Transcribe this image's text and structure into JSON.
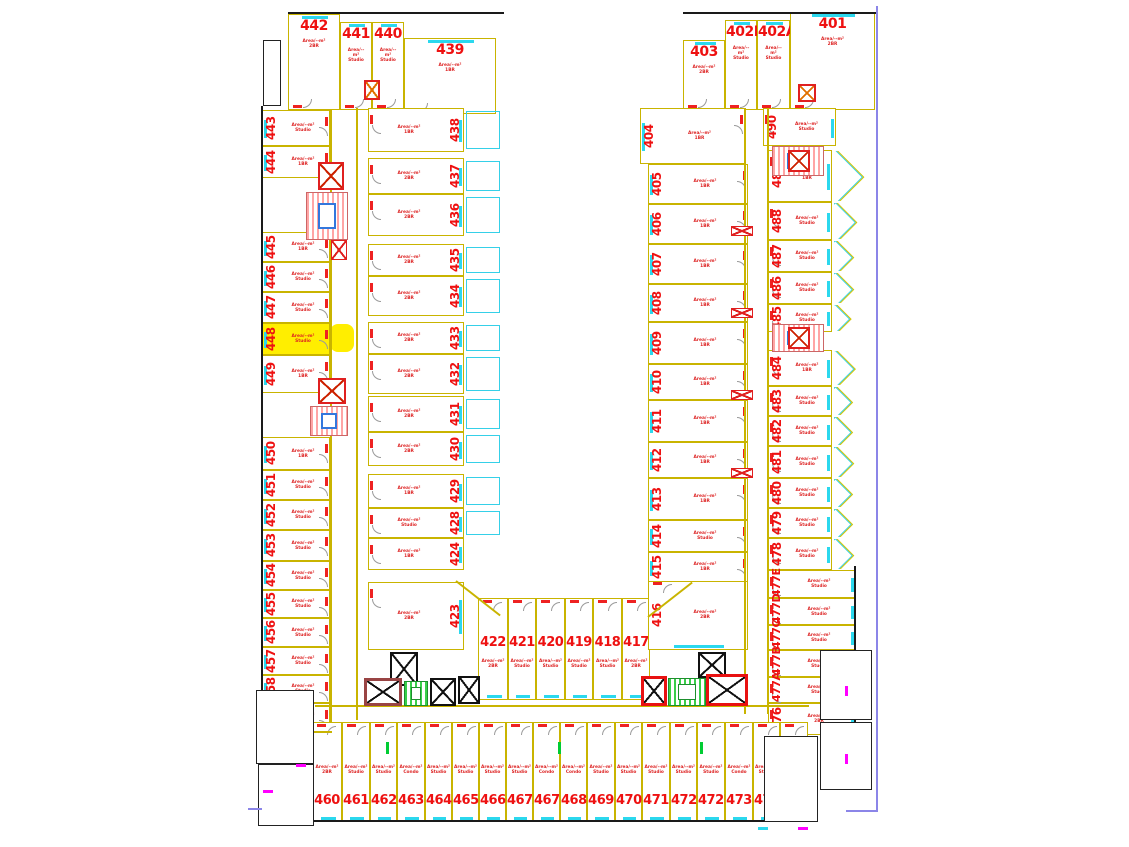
{
  "drawing": {
    "kind": "residential-floor-plan",
    "highlighted_unit": "448",
    "colors": {
      "unit_number_red": "#ee1111",
      "cell_line_yellow": "#c9b400",
      "wall_black": "#1a1a1a",
      "window_cyan": "#2bd8ee",
      "door_red": "#ee2222",
      "highlight_yellow": "#ffee00",
      "boundary_purple": "#8b85e8",
      "stair_hatch_pink": "#ffa5a5",
      "stair_hatch_green": "#39cf4a",
      "elevator_red": "#e02020",
      "tick_magenta": "#ff00ff",
      "tick_green": "#00cc33"
    }
  },
  "groups": {
    "top_left_block": {
      "units": [
        {
          "number": "442",
          "area": "Area/--m²",
          "type": "2BR"
        },
        {
          "number": "441",
          "area": "Area/--m²",
          "type": "Studio"
        },
        {
          "number": "440",
          "area": "Area/--m²",
          "type": "Studio"
        },
        {
          "number": "439",
          "area": "Area/--m²",
          "type": "1BR"
        }
      ]
    },
    "left_outer_column": {
      "units": [
        {
          "number": "443",
          "area": "Area/--m²",
          "type": "Studio"
        },
        {
          "number": "444",
          "area": "Area/--m²",
          "type": "1BR"
        },
        {
          "number": "445",
          "area": "Area/--m²",
          "type": "1BR"
        },
        {
          "number": "446",
          "area": "Area/--m²",
          "type": "Studio"
        },
        {
          "number": "447",
          "area": "Area/--m²",
          "type": "Studio"
        },
        {
          "number": "448",
          "area": "Area/--m²",
          "type": "Studio",
          "highlighted": true
        },
        {
          "number": "449",
          "area": "Area/--m²",
          "type": "1BR"
        },
        {
          "number": "450",
          "area": "Area/--m²",
          "type": "1BR"
        },
        {
          "number": "451",
          "area": "Area/--m²",
          "type": "Studio"
        },
        {
          "number": "452",
          "area": "Area/--m²",
          "type": "Studio"
        },
        {
          "number": "453",
          "area": "Area/--m²",
          "type": "Studio"
        },
        {
          "number": "454",
          "area": "Area/--m²",
          "type": "Studio"
        },
        {
          "number": "455",
          "area": "Area/--m²",
          "type": "Studio"
        },
        {
          "number": "456",
          "area": "Area/--m²",
          "type": "Studio"
        },
        {
          "number": "457",
          "area": "Area/--m²",
          "type": "Studio"
        },
        {
          "number": "458",
          "area": "Area/--m²",
          "type": "Studio"
        },
        {
          "number": "459",
          "area": "Area/--m²",
          "type": "1BR"
        }
      ]
    },
    "left_inner_column": {
      "units": [
        {
          "number": "438",
          "area": "Area/--m²",
          "type": "1BR"
        },
        {
          "number": "437",
          "area": "Area/--m²",
          "type": "2BR"
        },
        {
          "number": "436",
          "area": "Area/--m²",
          "type": "2BR"
        },
        {
          "number": "435",
          "area": "Area/--m²",
          "type": "2BR"
        },
        {
          "number": "434",
          "area": "Area/--m²",
          "type": "2BR"
        },
        {
          "number": "433",
          "area": "Area/--m²",
          "type": "2BR"
        },
        {
          "number": "432",
          "area": "Area/--m²",
          "type": "2BR"
        },
        {
          "number": "431",
          "area": "Area/--m²",
          "type": "2BR"
        },
        {
          "number": "430",
          "area": "Area/--m²",
          "type": "2BR"
        },
        {
          "number": "429",
          "area": "Area/--m²",
          "type": "1BR"
        },
        {
          "number": "428",
          "area": "Area/--m²",
          "type": "Studio"
        },
        {
          "number": "424",
          "area": "Area/--m²",
          "type": "1BR"
        },
        {
          "number": "423",
          "area": "Area/--m²",
          "type": "2BR"
        }
      ]
    },
    "bottom_middle_row": {
      "units": [
        {
          "number": "422",
          "area": "Area/--m²",
          "type": "2BR"
        },
        {
          "number": "421",
          "area": "Area/--m²",
          "type": "Studio"
        },
        {
          "number": "420",
          "area": "Area/--m²",
          "type": "Studio"
        },
        {
          "number": "419",
          "area": "Area/--m²",
          "type": "Studio"
        },
        {
          "number": "418",
          "area": "Area/--m²",
          "type": "Studio"
        },
        {
          "number": "417",
          "area": "Area/--m²",
          "type": "2BR"
        }
      ]
    },
    "unit_416": {
      "units": [
        {
          "number": "416",
          "area": "Area/--m²",
          "type": "2BR"
        }
      ]
    },
    "top_right_block": {
      "units": [
        {
          "number": "403",
          "area": "Area/--m²",
          "type": "2BR"
        },
        {
          "number": "402B",
          "area": "Area/--m²",
          "type": "Studio"
        },
        {
          "number": "402A",
          "area": "Area/--m²",
          "type": "Studio"
        },
        {
          "number": "401",
          "area": "Area/--m²",
          "type": "2BR"
        }
      ]
    },
    "right_inner_column": {
      "units": [
        {
          "number": "404",
          "area": "Area/--m²",
          "type": "1BR"
        },
        {
          "number": "405",
          "area": "Area/--m²",
          "type": "1BR"
        },
        {
          "number": "406",
          "area": "Area/--m²",
          "type": "1BR"
        },
        {
          "number": "407",
          "area": "Area/--m²",
          "type": "1BR"
        },
        {
          "number": "408",
          "area": "Area/--m²",
          "type": "1BR"
        },
        {
          "number": "409",
          "area": "Area/--m²",
          "type": "1BR"
        },
        {
          "number": "410",
          "area": "Area/--m²",
          "type": "1BR"
        },
        {
          "number": "411",
          "area": "Area/--m²",
          "type": "1BR"
        },
        {
          "number": "412",
          "area": "Area/--m²",
          "type": "1BR"
        },
        {
          "number": "413",
          "area": "Area/--m²",
          "type": "1BR"
        },
        {
          "number": "414",
          "area": "Area/--m²",
          "type": "Studio"
        },
        {
          "number": "415",
          "area": "Area/--m²",
          "type": "1BR"
        }
      ]
    },
    "right_outer_column": {
      "units": [
        {
          "number": "490",
          "area": "Area/--m²",
          "type": "Studio"
        },
        {
          "number": "489",
          "area": "Area/--m²",
          "type": "1BR"
        },
        {
          "number": "488",
          "area": "Area/--m²",
          "type": "Studio"
        },
        {
          "number": "487",
          "area": "Area/--m²",
          "type": "Studio"
        },
        {
          "number": "486",
          "area": "Area/--m²",
          "type": "Studio"
        },
        {
          "number": "485",
          "area": "Area/--m²",
          "type": "Studio"
        },
        {
          "number": "484",
          "area": "Area/--m²",
          "type": "1BR"
        },
        {
          "number": "483",
          "area": "Area/--m²",
          "type": "Studio"
        },
        {
          "number": "482",
          "area": "Area/--m²",
          "type": "Studio"
        },
        {
          "number": "481",
          "area": "Area/--m²",
          "type": "Studio"
        },
        {
          "number": "480",
          "area": "Area/--m²",
          "type": "Studio"
        },
        {
          "number": "479",
          "area": "Area/--m²",
          "type": "Studio"
        },
        {
          "number": "478",
          "area": "Area/--m²",
          "type": "Studio"
        },
        {
          "number": "477E",
          "area": "Area/--m²",
          "type": "Studio"
        },
        {
          "number": "477D",
          "area": "Area/--m²",
          "type": "Studio"
        },
        {
          "number": "477C",
          "area": "Area/--m²",
          "type": "Studio"
        },
        {
          "number": "477B",
          "area": "Area/--m²",
          "type": "Studio"
        },
        {
          "number": "477A",
          "area": "Area/--m²",
          "type": "Studio"
        },
        {
          "number": "476",
          "area": "Area/--m²",
          "type": "2BR"
        }
      ]
    },
    "bottom_row": {
      "units": [
        {
          "number": "460",
          "area": "Area/--m²",
          "type": "2BR"
        },
        {
          "number": "461",
          "area": "Area/--m²",
          "type": "Studio"
        },
        {
          "number": "462",
          "area": "Area/--m²",
          "type": "Studio"
        },
        {
          "number": "463",
          "area": "Area/--m²",
          "type": "Condo"
        },
        {
          "number": "464",
          "area": "Area/--m²",
          "type": "Studio"
        },
        {
          "number": "465",
          "area": "Area/--m²",
          "type": "Studio"
        },
        {
          "number": "466",
          "area": "Area/--m²",
          "type": "Studio"
        },
        {
          "number": "467A",
          "area": "Area/--m²",
          "type": "Studio"
        },
        {
          "number": "467B",
          "area": "Area/--m²",
          "type": "Condo"
        },
        {
          "number": "468",
          "area": "Area/--m²",
          "type": "Condo"
        },
        {
          "number": "469",
          "area": "Area/--m²",
          "type": "Studio"
        },
        {
          "number": "470",
          "area": "Area/--m²",
          "type": "Studio"
        },
        {
          "number": "471",
          "area": "Area/--m²",
          "type": "Studio"
        },
        {
          "number": "472A",
          "area": "Area/--m²",
          "type": "Studio"
        },
        {
          "number": "472B",
          "area": "Area/--m²",
          "type": "Studio"
        },
        {
          "number": "473",
          "area": "Area/--m²",
          "type": "Condo"
        },
        {
          "number": "474",
          "area": "Area/--m²",
          "type": "Studio"
        },
        {
          "number": "475",
          "area": "Area/--m²",
          "type": "Studio"
        }
      ]
    }
  }
}
